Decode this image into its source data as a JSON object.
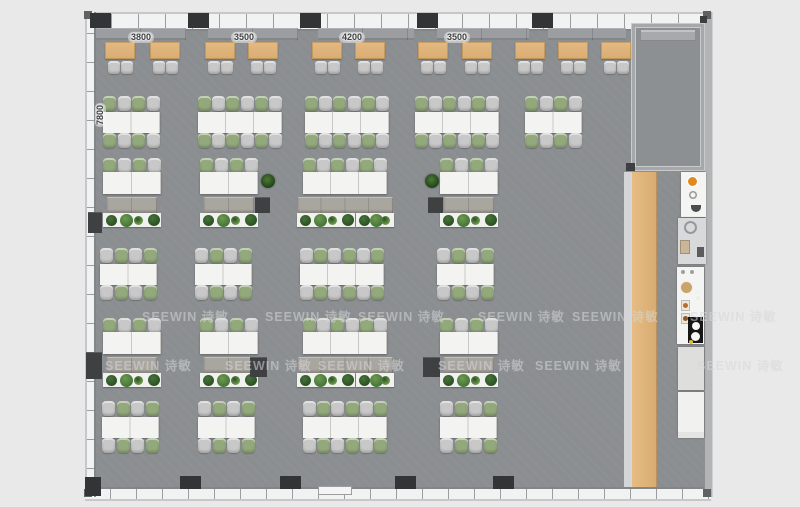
{
  "watermark": {
    "text": "SEEWIN 诗敏",
    "rows": [
      {
        "y": 306,
        "xs": [
          142,
          265,
          358,
          478,
          572,
          690
        ]
      },
      {
        "y": 355,
        "xs": [
          105,
          225,
          318,
          438,
          535,
          697
        ]
      }
    ]
  },
  "dimensions": {
    "top": [
      {
        "label": "3800",
        "cx": 141
      },
      {
        "label": "3500",
        "cx": 244
      },
      {
        "label": "4200",
        "cx": 352
      },
      {
        "label": "3500",
        "cx": 457
      }
    ],
    "side": {
      "label": "7800",
      "x": 95,
      "y": 103
    }
  },
  "colors": {
    "floor": "#8b8e90",
    "background": "#e9e9e9",
    "wood": "#dfb57e",
    "chair_green": "#93a97c",
    "chair_gray": "#c7c8c7",
    "table_white": "#f3f3f1",
    "credenza": "#a9a59f",
    "column": "#323436",
    "accent_orange": "#e08a1c",
    "plants": [
      "#2c5123",
      "#46743a",
      "#6d9b4f"
    ]
  },
  "plan": {
    "benches": [
      {
        "x": 96,
        "w": 90
      },
      {
        "x": 208,
        "w": 90
      },
      {
        "x": 318,
        "w": 96
      },
      {
        "x": 437,
        "w": 92
      },
      {
        "x": 548,
        "w": 78
      }
    ],
    "top_tables": [
      105,
      150,
      205,
      248,
      312,
      355,
      418,
      462,
      515,
      558,
      601
    ],
    "desk_rows": [
      {
        "y": 96,
        "start": 0,
        "clusters": [
          {
            "x": 103,
            "seats": 4
          },
          {
            "x": 198,
            "seats": 6
          },
          {
            "x": 305,
            "seats": 6
          },
          {
            "x": 415,
            "seats": 6
          },
          {
            "x": 525,
            "seats": 4
          }
        ]
      },
      {
        "y": 248,
        "start": 1,
        "clusters": [
          {
            "x": 100,
            "seats": 4
          },
          {
            "x": 195,
            "seats": 4
          },
          {
            "x": 300,
            "seats": 6
          },
          {
            "x": 437,
            "seats": 4
          }
        ]
      },
      {
        "y": 401,
        "start": 1,
        "clusters": [
          {
            "x": 102,
            "seats": 4
          },
          {
            "x": 198,
            "seats": 4
          },
          {
            "x": 303,
            "seats": 6
          },
          {
            "x": 440,
            "seats": 4
          }
        ]
      }
    ],
    "exec_rows": [
      {
        "y": 158,
        "clusters": [
          {
            "x": 103,
            "seats": 4
          },
          {
            "x": 200,
            "seats": 4
          },
          {
            "x": 303,
            "seats": 6,
            "wide": 1
          },
          {
            "x": 440,
            "seats": 4
          }
        ]
      },
      {
        "y": 318,
        "clusters": [
          {
            "x": 103,
            "seats": 4
          },
          {
            "x": 200,
            "seats": 4
          },
          {
            "x": 303,
            "seats": 6,
            "wide": 1
          },
          {
            "x": 440,
            "seats": 4
          }
        ]
      }
    ],
    "potted": [
      [
        261,
        174
      ],
      [
        425,
        174
      ]
    ],
    "cabinets": [
      {
        "x": 255,
        "y": 197,
        "w": 15,
        "h": 16
      },
      {
        "x": 428,
        "y": 197,
        "w": 15,
        "h": 16
      },
      {
        "x": 88,
        "y": 212,
        "w": 14,
        "h": 21
      },
      {
        "x": 250,
        "y": 357,
        "w": 17,
        "h": 20
      },
      {
        "x": 423,
        "y": 357,
        "w": 17,
        "h": 20
      },
      {
        "x": 86,
        "y": 352,
        "w": 16,
        "h": 27
      }
    ],
    "columns_top": [
      90,
      188,
      300,
      417,
      532
    ],
    "columns_bottom": [
      180,
      280,
      395,
      493
    ],
    "door": {
      "x": 318,
      "w": 34
    },
    "kitchen": [
      {
        "type": "coffee",
        "x": 681,
        "y": 172,
        "w": 25,
        "h": 45
      },
      {
        "type": "sink",
        "x": 678,
        "y": 218,
        "w": 28,
        "h": 46
      },
      {
        "type": "prep",
        "x": 677,
        "y": 267,
        "w": 27,
        "h": 77
      },
      {
        "type": "panel",
        "x": 678,
        "y": 347,
        "w": 26,
        "h": 43
      },
      {
        "type": "cabinet",
        "x": 678,
        "y": 392,
        "w": 26,
        "h": 46
      }
    ]
  }
}
